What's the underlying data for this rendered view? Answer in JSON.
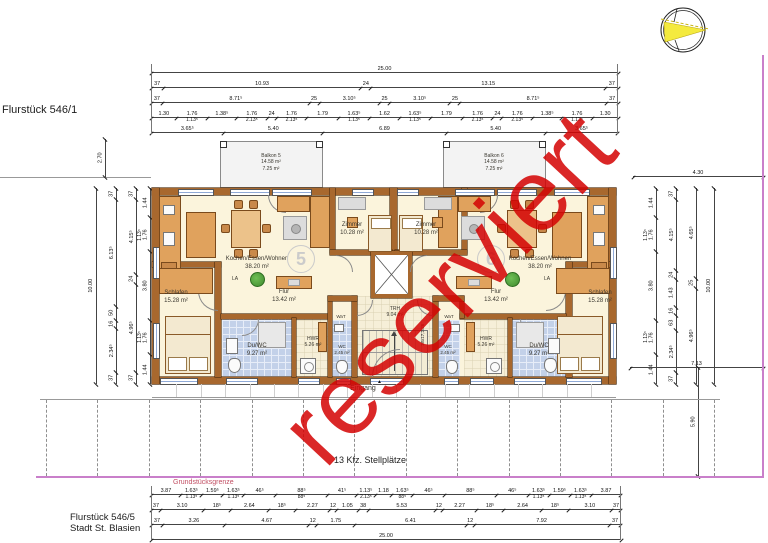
{
  "page": {
    "flurstueck_top": "Flurstück 546/1",
    "flurstueck_bottom_line1": "Flurstück 546/5",
    "flurstueck_bottom_line2": "Stadt St. Blasien",
    "boundary_label": "Grundstücksgrenze",
    "parking_label": "13 Kfz. Stellplätze",
    "entrance_label": "Eingang",
    "entrance_marker": "▲",
    "watermark": "reserviert"
  },
  "colors": {
    "wall": "#a8682e",
    "floor": "#fbf4dc",
    "bath_tile": "#c3d1e9",
    "hall_tile": "#f6efd8",
    "furniture": "#e0a25d",
    "balcony": "#f3f3f3",
    "boundary_line": "#c97fca",
    "boundary_text": "#c24f63",
    "watermark_red": "#d40404",
    "plant_green": "#3f8a2e"
  },
  "apartment5": {
    "number": "5",
    "balcony": {
      "line1": "Balkon 5",
      "line2": "14.58 m²",
      "line3": "7.25 m²"
    },
    "living": {
      "name": "Kochen/Essen/Wohnen",
      "area": "38.20 m²"
    },
    "zimmer": {
      "name": "Zimmer",
      "area": "10.28 m²"
    },
    "schlafen": {
      "name": "Schlafen",
      "area": "15.28 m²"
    },
    "flur": {
      "name": "Flur",
      "area": "13.42 m²"
    },
    "duwc": {
      "name": "Du/WC",
      "area": "9.27 m²"
    },
    "hwr": {
      "name": "HWR",
      "area": "5.26 m²"
    },
    "wc": {
      "name": "WC",
      "area": "2.45 m²"
    },
    "wat": "WaT",
    "la": "LA"
  },
  "apartment6": {
    "number": "6",
    "balcony": {
      "line1": "Balkon 6",
      "line2": "14.58 m²",
      "line3": "7.25 m²"
    },
    "living": {
      "name": "Kochen/Essen/Wohnen",
      "area": "38.20 m²"
    },
    "zimmer": {
      "name": "Zimmer",
      "area": "10.28 m²"
    },
    "schlafen": {
      "name": "Schlafen",
      "area": "15.28 m²"
    },
    "flur": {
      "name": "Flur",
      "area": "13.42 m²"
    },
    "duwc": {
      "name": "Du/WC",
      "area": "9.27 m²"
    },
    "hwr": {
      "name": "HWR",
      "area": "5.26 m²"
    },
    "wc": {
      "name": "WC",
      "area": "2.45 m²"
    },
    "wat": "WaT",
    "la": "LA"
  },
  "core": {
    "trh_name": "TRH",
    "trh_area": "9.04 m²",
    "stair_note": "18x17,2/26"
  },
  "dims": {
    "balcony_left": "2.70",
    "right_top": "4.30",
    "right_mid": "7.13",
    "right_low": "5.90",
    "top_rows": [
      [
        "25.00"
      ],
      [
        "37",
        "10.93",
        "24",
        "13.15",
        "37"
      ],
      [
        "37",
        "8.71⁵",
        "25",
        "3.10⁵",
        "25",
        "3.10⁵",
        "25",
        "8.71⁵",
        "37"
      ],
      [
        "1.30",
        {
          "v": "1.76",
          "s": "1.13⁵"
        },
        "1.38⁵",
        {
          "v": "1.76",
          "s": "2.13⁵"
        },
        "24",
        {
          "v": "1.76",
          "s": "2.13⁵"
        },
        "1.79",
        {
          "v": "1.63⁵",
          "s": "1.13⁵"
        },
        "1.62",
        {
          "v": "1.63⁵",
          "s": "1.13⁵"
        },
        "1.79",
        {
          "v": "1.76",
          "s": "2.13⁵"
        },
        "24",
        {
          "v": "1.76",
          "s": "2.13⁵"
        },
        "1.38⁵",
        {
          "v": "1.76",
          "s": "1.13⁵"
        },
        "1.30"
      ],
      [
        "3.65⁵",
        "5.40",
        "6.89",
        "5.40",
        "3.65⁵"
      ]
    ],
    "bottom_rows": [
      [
        "3.87",
        {
          "v": "1.63⁵",
          "s": "1.13⁵"
        },
        "1.59⁵",
        {
          "v": "1.63⁵",
          "s": "1.13⁵"
        },
        "46⁵",
        {
          "v": "88⁵",
          "s": "88⁵"
        },
        "41⁵",
        {
          "v": "1.13⁵",
          "s": "2.13⁵"
        },
        "1.18",
        {
          "v": "1.63⁵",
          "s": "88⁵"
        },
        "46⁵",
        "88⁵",
        "46⁵",
        {
          "v": "1.63⁵",
          "s": "1.13⁵"
        },
        "1.59⁵",
        {
          "v": "1.63⁵",
          "s": "1.13⁵"
        },
        "3.87"
      ],
      [
        "37",
        "3.10",
        "18⁵",
        "2.64",
        "18⁵",
        "2.27",
        "12",
        "1.05",
        "38",
        "5.53",
        "12",
        "2.27",
        "18⁵",
        "2.64",
        "18⁵",
        "3.10",
        "37"
      ],
      [
        "37",
        "3.26",
        "4.67",
        "12",
        "1.75",
        "6.41",
        "12",
        "7.92",
        "37"
      ],
      [
        "25.00"
      ]
    ],
    "left_cols": [
      [
        "10.00"
      ],
      [
        "37",
        "6.13⁵",
        "50",
        "16",
        "2.34⁵",
        "37"
      ],
      [
        "37",
        "4.15⁵",
        "24",
        "4.96⁵",
        "37"
      ],
      [
        "1.44",
        {
          "v": "1.76",
          "s": "1.13⁵"
        },
        "3.80",
        {
          "v": "1.76",
          "s": "1.13⁵"
        },
        "1.44"
      ]
    ],
    "right_cols": [
      [
        "1.44",
        {
          "v": "1.76",
          "s": "1.13⁵"
        },
        "3.80",
        {
          "v": "1.76",
          "s": "1.13⁵"
        },
        "1.44"
      ],
      [
        "37",
        "4.15⁵",
        "24",
        "1.43",
        "16",
        "63",
        "2.34⁵",
        "37"
      ],
      [
        "4.65⁵",
        "25",
        "4.96⁵"
      ],
      [
        "10.00"
      ]
    ]
  }
}
